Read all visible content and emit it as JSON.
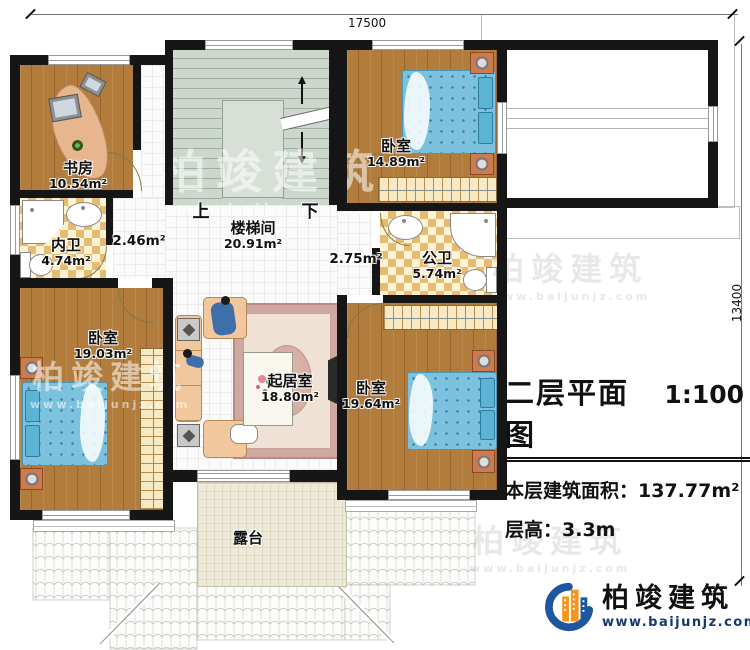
{
  "dims": {
    "top": "17500",
    "right": "13400"
  },
  "rooms": {
    "study": {
      "name": "书房",
      "area": "10.54m²"
    },
    "bath_inner": {
      "name": "内卫",
      "area": "4.74m²"
    },
    "hall_left": {
      "area": "2.46m²"
    },
    "stairwell": {
      "name": "楼梯间",
      "area": "20.91m²"
    },
    "hall_right": {
      "area": "2.75m²"
    },
    "bedroom_top": {
      "name": "卧室",
      "area": "14.89m²"
    },
    "bath_public": {
      "name": "公卫",
      "area": "5.74m²"
    },
    "bedroom_left": {
      "name": "卧室",
      "area": "19.03m²"
    },
    "living": {
      "name": "起居室",
      "area": "18.80m²"
    },
    "bedroom_right": {
      "name": "卧室",
      "area": "19.64m²"
    },
    "terrace": {
      "name": "露台"
    }
  },
  "stairs": {
    "up": "上",
    "down": "下"
  },
  "title_block": {
    "title": "二层平面图",
    "scale": "1:100",
    "area_label": "本层建筑面积：",
    "area_value": "137.77m²",
    "height_label": "层高：",
    "height_value": "3.3m"
  },
  "logo": {
    "name": "柏竣建筑",
    "url": "www.baijunjz.com"
  },
  "watermark": {
    "name": "柏竣建筑",
    "url": "www.baijunjz.com"
  },
  "colors": {
    "wall": "#161616",
    "wood": "#b17c3c",
    "stair": "#cdd7cd",
    "bed": "#7cc2de",
    "checker": "#e6bc72",
    "terrace": "#edead9",
    "accent_blue": "#1e56a0",
    "accent_orange": "#f7941d"
  }
}
